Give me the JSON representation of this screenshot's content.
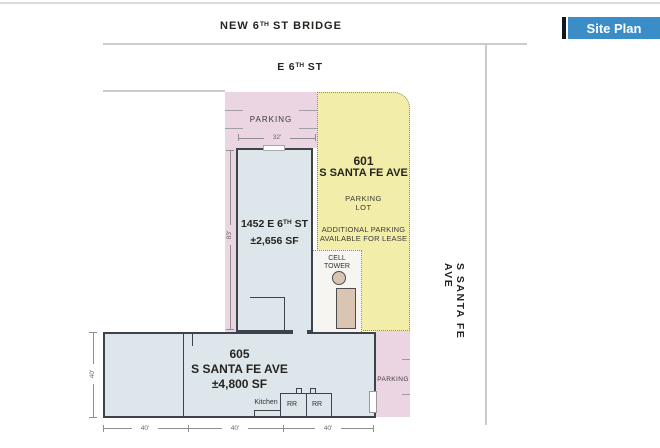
{
  "header": {
    "bridge_label": {
      "p1": "NEW 6",
      "sup": "TH",
      "p2": " ST BRIDGE"
    },
    "site_plan_button": "Site Plan"
  },
  "streets": {
    "e6th": {
      "p1": "E 6",
      "sup": "TH",
      "p2": " ST"
    },
    "s_santa_fe": "S SANTA FE AVE"
  },
  "zones": {
    "top_parking_label": "PARKING",
    "lot_601": {
      "address_line1": "601",
      "address_line2": "S SANTA FE AVE",
      "use_line1": "PARKING",
      "use_line2": "LOT",
      "note_line1": "ADDITIONAL PARKING",
      "note_line2": "AVAILABLE FOR LEASE"
    },
    "cell_tower": {
      "line1": "CELL",
      "line2": "TOWER"
    },
    "right_parking_label": "PARKING"
  },
  "buildings": {
    "b1452": {
      "address": {
        "p1": "1452 E 6",
        "sup": "TH",
        "p2": " ST"
      },
      "area": "±2,656 SF"
    },
    "b605": {
      "address_line1": "605",
      "address_line2": "S SANTA FE AVE",
      "area": "±4,800 SF",
      "rooms": {
        "kitchen": "Kitchen",
        "rr1": "RR",
        "rr2": "RR"
      }
    }
  },
  "dimensions": {
    "top_width": "32'",
    "b1452_height": "83'",
    "b605_height": "40'",
    "bottom": [
      "40'",
      "40'",
      "40'"
    ]
  },
  "colors": {
    "accent_blue": "#3b8dc8",
    "button_bar": "#0e1824",
    "parking_pink": "#ecd5e3",
    "lot_yellow": "#f2eda8",
    "building_fill": "#dde6eb",
    "tan": "#d9c5b2",
    "wall": "#3d424b",
    "street_line": "#cccccc"
  }
}
